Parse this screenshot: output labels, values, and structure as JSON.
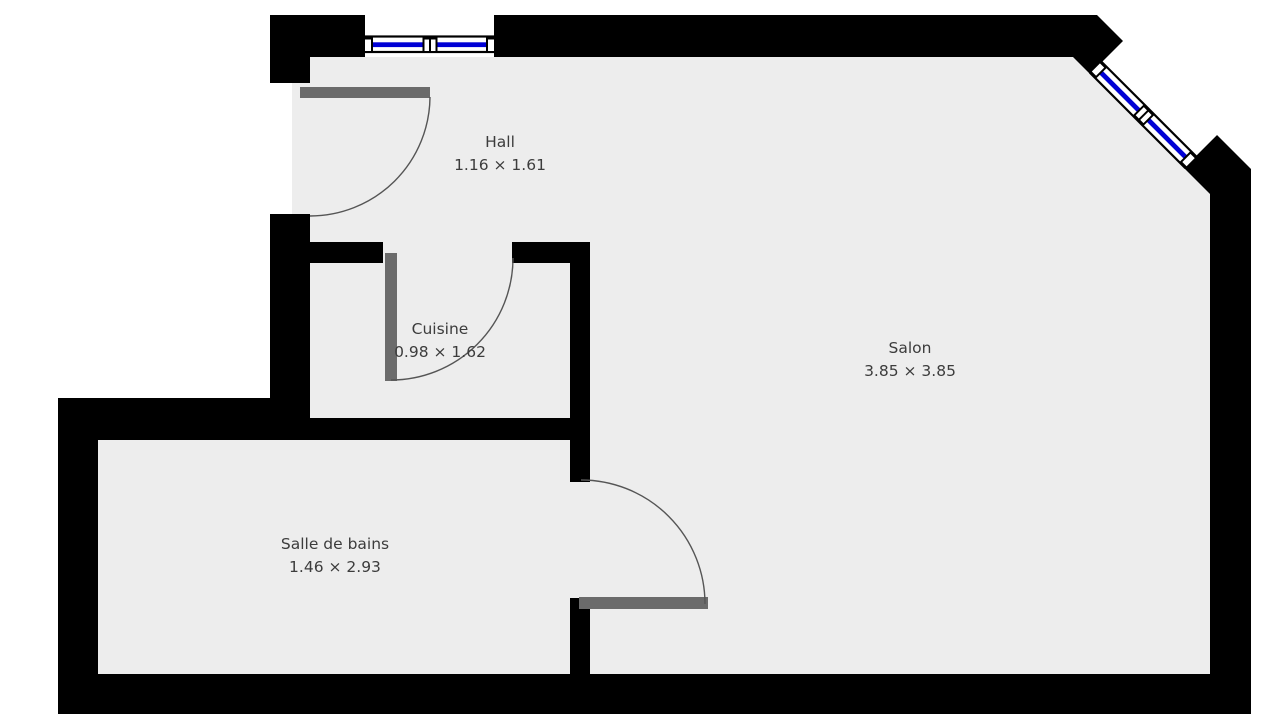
{
  "plan": {
    "type": "floor-plan",
    "rooms": [
      {
        "id": "hall",
        "name": "Hall",
        "dimensions": "1.16 × 1.61"
      },
      {
        "id": "cuisine",
        "name": "Cuisine",
        "dimensions": "0.98 × 1.62"
      },
      {
        "id": "salon",
        "name": "Salon",
        "dimensions": "3.85 × 3.85"
      },
      {
        "id": "salle-de-bains",
        "name": "Salle de bains",
        "dimensions": "1.46 × 2.93"
      }
    ]
  },
  "colors": {
    "wall": "#000000",
    "floor": "#ededed",
    "outside": "#ffffff",
    "door_leaf": "#6b6b6b",
    "swing_arc": "#555555",
    "window_glass": "#0000d5",
    "window_frame": "#ffffff",
    "label_text": "#3c3c3c"
  }
}
